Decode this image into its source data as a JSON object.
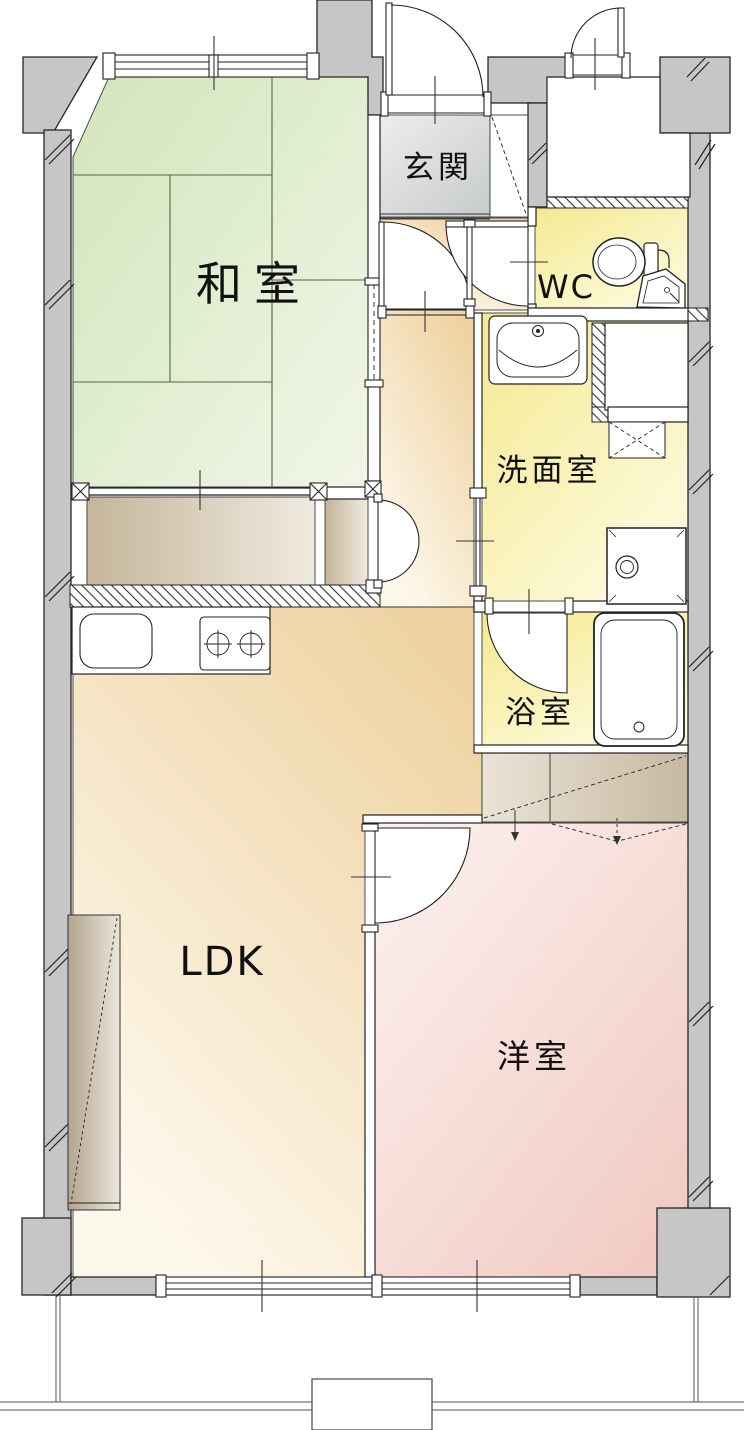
{
  "floorplan": {
    "rooms": [
      {
        "id": "washitsu",
        "label": "和室"
      },
      {
        "id": "genkan",
        "label": "玄関"
      },
      {
        "id": "wc",
        "label": "WC"
      },
      {
        "id": "senmenshitsu",
        "label": "洗面室"
      },
      {
        "id": "yokushitsu",
        "label": "浴室"
      },
      {
        "id": "ldk",
        "label": "LDK"
      },
      {
        "id": "yoshitsu",
        "label": "洋室"
      }
    ],
    "colors": {
      "wall_gray": "#c6c6c6",
      "tatami_green": "#dcebc4",
      "wet_area_yellow": "#f6ec9c",
      "ldk_beige": "#f2d9ad",
      "western_pink": "#f4d2ca",
      "entrance_tile": "#d9dbdc",
      "closet_tan": "#cdbfa7",
      "outline": "#1f1f1f"
    },
    "fixtures": [
      {
        "name": "toilet"
      },
      {
        "name": "corner-hand-basin"
      },
      {
        "name": "washbasin"
      },
      {
        "name": "washing-machine-space"
      },
      {
        "name": "washer-pan"
      },
      {
        "name": "bathtub"
      },
      {
        "name": "kitchen-sink"
      },
      {
        "name": "two-burner-stove"
      }
    ]
  }
}
